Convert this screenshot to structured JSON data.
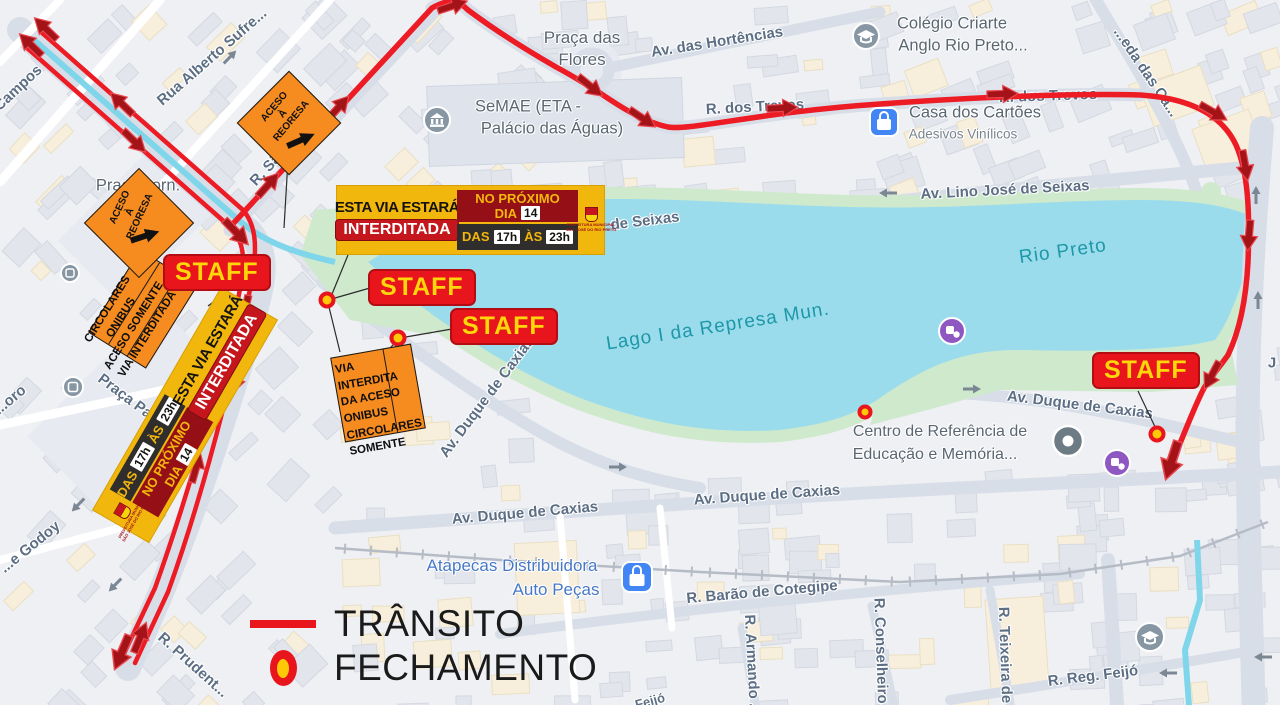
{
  "legend": {
    "transito": "TRÂNSITO",
    "fechamento": "FECHAMENTO"
  },
  "staff_label": "STAFF",
  "banner": {
    "line1": "ESTA VIA ESTARÁ",
    "line2": "INTERDITADA",
    "proximo": "NO PRÓXIMO",
    "dia": "DIA",
    "dia_num": "14",
    "das": "DAS",
    "hora1": "17h",
    "as": "ÀS",
    "hora2": "23h",
    "logo1": "PREFEITURA MUNICIPAL",
    "logo2": "SÃO JOSÉ DO RIO PRETO"
  },
  "signs": {
    "diamond_l1": "ACESO",
    "diamond_l2": "À",
    "diamond_l3": "REORESA",
    "rect1_l1": "CIRCOLARES",
    "rect1_l2": "ONIBUS",
    "rect1_l3": "ACESO SOMENTE",
    "rect1_l4": "VIA INTERDITADA",
    "rect2_l1": "VIA",
    "rect2_l2": "INTERDITA",
    "rect2_l3": "DA  ACESO",
    "rect2_l4": "ONIBUS",
    "rect2_l5": "CIRCOLARES",
    "rect2_l6": "SOMENTE"
  },
  "streets": {
    "campos": "Campos",
    "rua_alberto": "Rua Alberto Sufre...",
    "sao_paulo": "R. São Paulo",
    "hortencias": "Av. das Hortências",
    "trevos": "R. dos Trevos",
    "alameda": "...eda das Ca...",
    "av_lino": "Av. Lino José de Seixas",
    "de_seixas": "de Seixas",
    "av_duque": "Av. Duque de Caxias",
    "barao": "R. Barão de Cotegipe",
    "armando": "R. Armando ...",
    "conselheiro": "R. Conselheiro...",
    "teixeira": "R. Teixeira de",
    "reg_feijo": "R. Reg. Feijó",
    "prudente": "R. Prudent...",
    "godoy": "...e Godoy",
    "oro": "...oro",
    "feijo": "Feijó",
    "jota": "J",
    "praca_pa": "Praça Pa..."
  },
  "places": {
    "praca_flores1": "Praça das",
    "praca_flores2": "Flores",
    "praca_jorn1": "Praça Jorn.",
    "praca_jorn2": "L...do",
    "semae1": "SeMAE (ETA -",
    "semae2": "Palácio das Águas)",
    "colegio1": "Colégio Criarte",
    "colegio2": "Anglo Rio Preto...",
    "casa1": "Casa dos Cartões",
    "casa2": "Adesivos Vinílicos",
    "centro1": "Centro de Referência de",
    "centro2": "Educação e Memória...",
    "atapecas1": "Atapecas Distribuidora",
    "atapecas2": "Auto Peças",
    "rio_preto": "Rio Preto",
    "lago": "Lago I da Represa Mun."
  },
  "colors": {
    "route": "#ec1b24",
    "closure_fill": "#ffc907",
    "closure_ring": "#e8151d",
    "sign_yellow": "#f2b70d",
    "sign_red": "#c4161c",
    "orange": "#f68b1f",
    "water": "#9bdcec",
    "green": "#cfe9cc"
  }
}
